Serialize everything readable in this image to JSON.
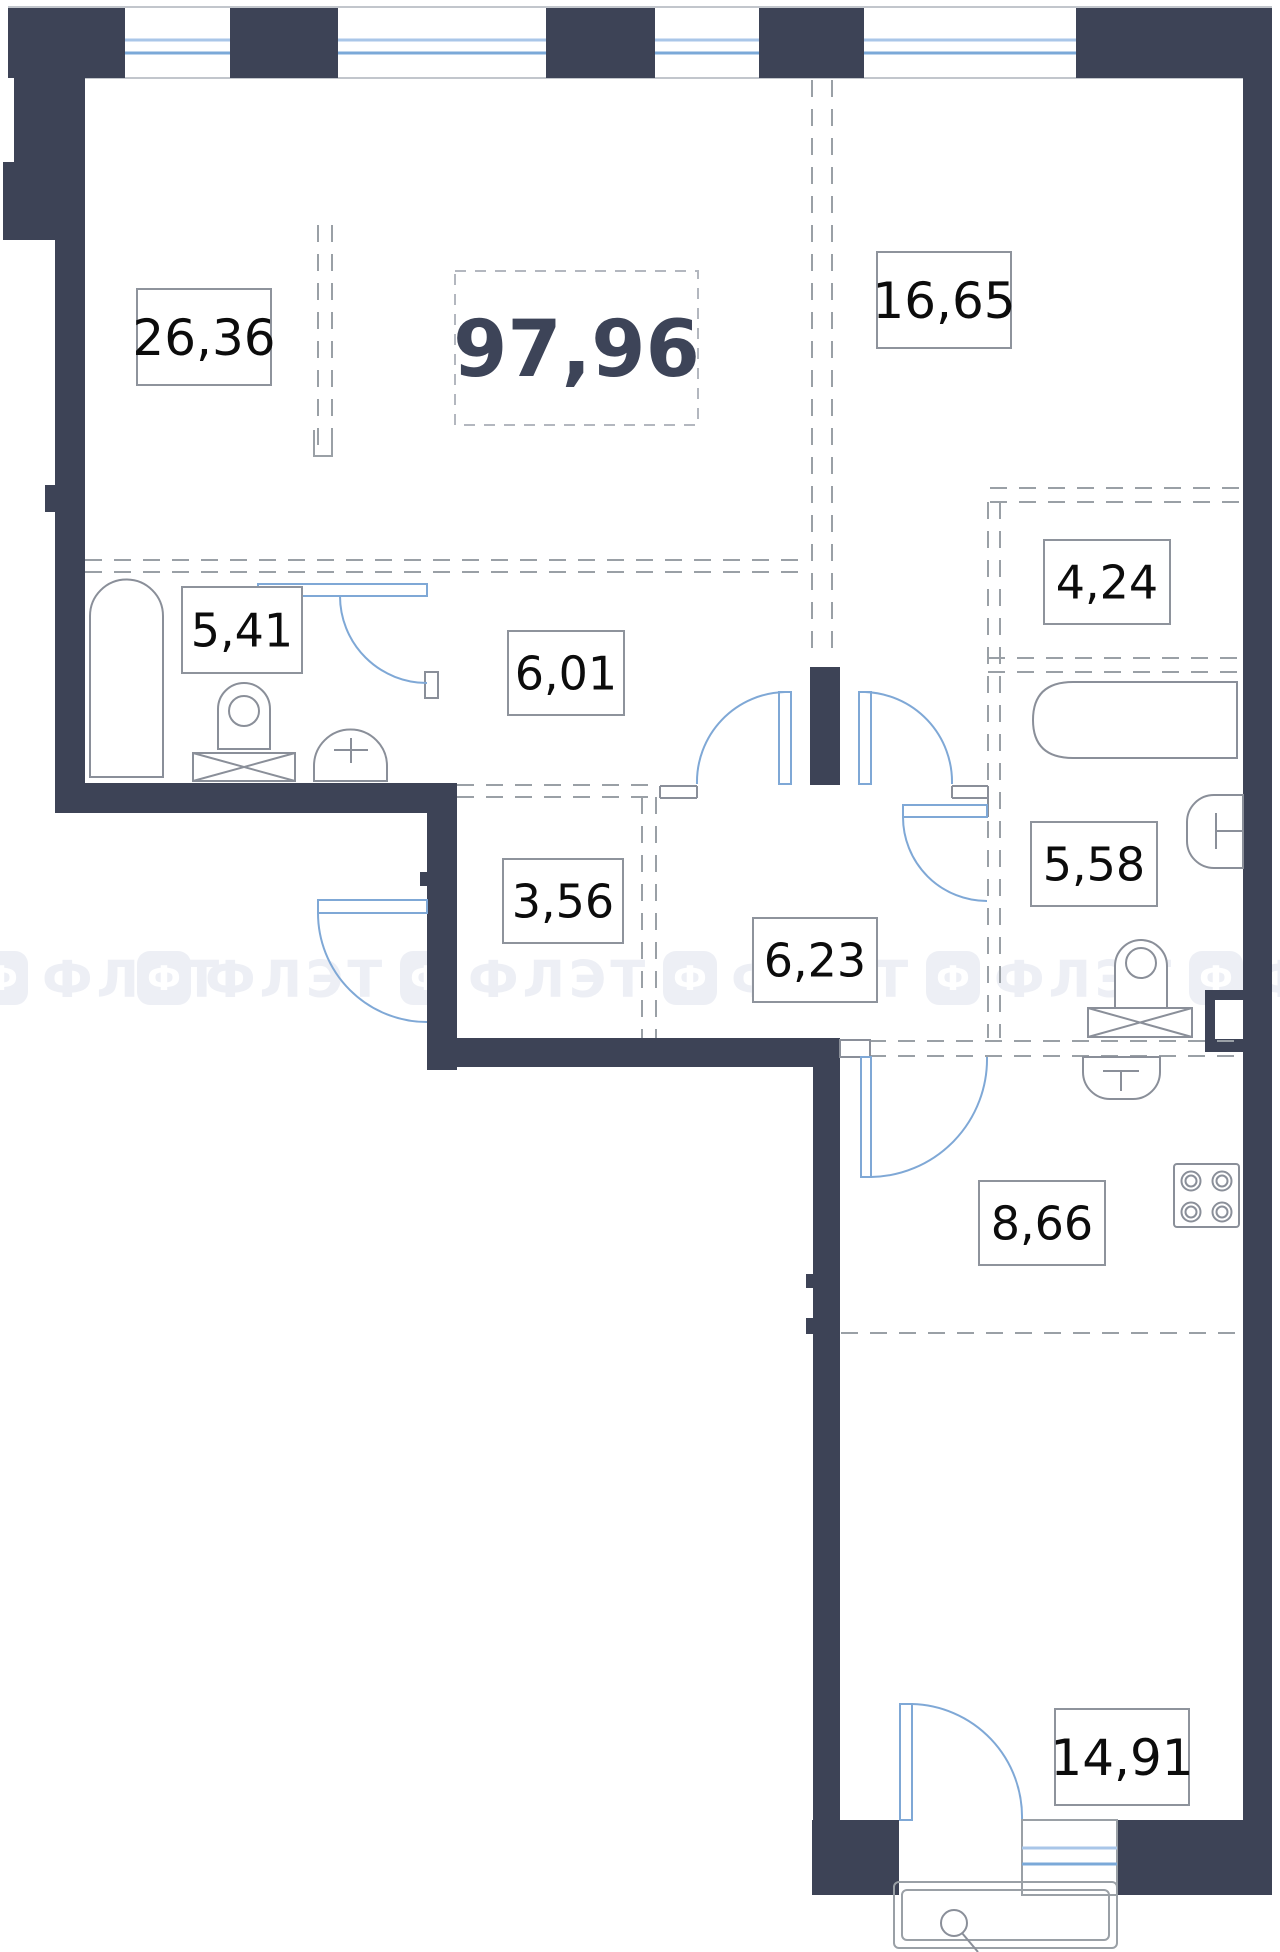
{
  "plan": {
    "title": "apartment-floor-plan",
    "total_area": "97,96",
    "total_box": {
      "x": 455,
      "y": 271,
      "w": 243,
      "h": 154,
      "fs": 78
    },
    "rooms": [
      {
        "name": "living-room",
        "area": "26,36",
        "cx": 204,
        "cy": 337,
        "w": 134,
        "h": 96,
        "fs": 50
      },
      {
        "name": "bedroom",
        "area": "16,65",
        "cx": 944,
        "cy": 300,
        "w": 134,
        "h": 96,
        "fs": 50
      },
      {
        "name": "loggia",
        "area": "4,24",
        "cx": 1107,
        "cy": 582,
        "w": 126,
        "h": 84,
        "fs": 46
      },
      {
        "name": "bathroom",
        "area": "5,41",
        "cx": 242,
        "cy": 630,
        "w": 120,
        "h": 86,
        "fs": 46
      },
      {
        "name": "hallway",
        "area": "6,01",
        "cx": 566,
        "cy": 673,
        "w": 116,
        "h": 84,
        "fs": 46
      },
      {
        "name": "bathroom-2",
        "area": "5,58",
        "cx": 1094,
        "cy": 864,
        "w": 126,
        "h": 84,
        "fs": 46
      },
      {
        "name": "corridor",
        "area": "3,56",
        "cx": 563,
        "cy": 901,
        "w": 120,
        "h": 84,
        "fs": 46
      },
      {
        "name": "hall",
        "area": "6,23",
        "cx": 815,
        "cy": 960,
        "w": 124,
        "h": 84,
        "fs": 46
      },
      {
        "name": "kitchen",
        "area": "8,66",
        "cx": 1042,
        "cy": 1223,
        "w": 126,
        "h": 84,
        "fs": 46
      },
      {
        "name": "room-2",
        "area": "14,91",
        "cx": 1122,
        "cy": 1757,
        "w": 134,
        "h": 96,
        "fs": 50
      }
    ]
  },
  "watermark": {
    "text": "ФЛЭТ",
    "icon_letter": "Ф",
    "row_y": 951,
    "icon_size": 54,
    "positions_x": [
      -26,
      137,
      400,
      663,
      926,
      1189
    ]
  },
  "fixtures": [
    "shower-cabin",
    "toilet",
    "washbasin",
    "bathtub",
    "wall-sink",
    "kitchen-sink",
    "stove-4-burner",
    "balcony"
  ],
  "colors": {
    "wall": "#3d4356",
    "label_border": "#8e939c",
    "label_text": "#0c0c0c",
    "total_text": "#3d4458",
    "door_blue": "#7fa8d6",
    "glass_light": "#a9c6e8",
    "glass_dark": "#7ba9d8",
    "fixture_line": "#8a8f99",
    "dash_line": "#9aa0a6",
    "edge_line": "#c2c6cc",
    "watermark": "#edeff5"
  }
}
